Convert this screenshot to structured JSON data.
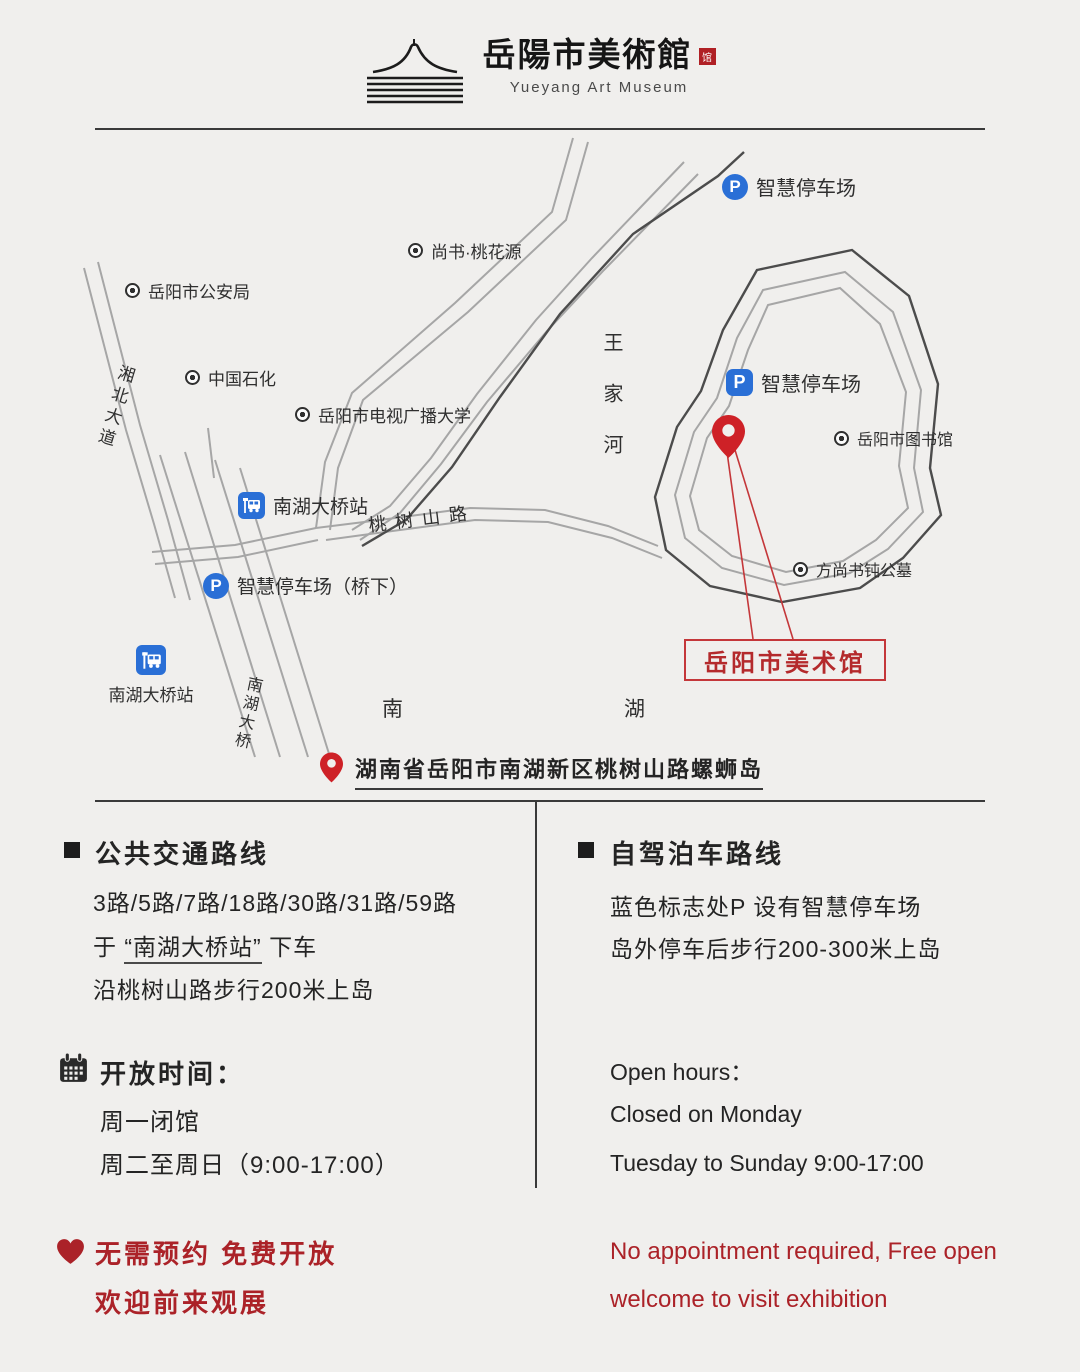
{
  "colors": {
    "red_text": "#ab2228",
    "red_line": "#c4373a",
    "blue": "#2a6fd6",
    "ink": "#2d2d2d",
    "bg": "#f0efed"
  },
  "logo": {
    "title_zh": "岳陽市美術館",
    "seal": "馆",
    "title_en": "Yueyang Art Museum"
  },
  "map": {
    "labels": {
      "p_letter": "P",
      "parking_top": "智慧停车场",
      "taohuayuan": "尚书·桃花源",
      "police": "岳阳市公安局",
      "sinopec": "中国石化",
      "university": "岳阳市电视广播大学",
      "parking_island": "智慧停车场",
      "library": "岳阳市图书馆",
      "bus_top": "南湖大桥站",
      "parking_bridge": "智慧停车场（桥下）",
      "tomb": "方尚书钝公墓",
      "bus_bottom": "南湖大桥站",
      "wangjiahe": "王家河",
      "xiangbei_avenue": "湘北大道",
      "taoshushan_road": "桃树山路",
      "nanhu_bridge": "南湖大桥",
      "lake_nan": "南",
      "lake_hu": "湖",
      "museum_callout": "岳阳市美术馆"
    }
  },
  "address": {
    "text": "湖南省岳阳市南湖新区桃树山路螺蛳岛"
  },
  "transit": {
    "title": "公共交通路线",
    "routes": "3路/5路/7路/18路/30路/31路/59路",
    "line2_prefix": "于",
    "line2_station": "“南湖大桥站”",
    "line2_suffix": "下车",
    "line3": "沿桃树山路步行200米上岛"
  },
  "driving": {
    "title": "自驾泊车路线",
    "line1": "蓝色标志处P 设有智慧停车场",
    "line2": "岛外停车后步行200-300米上岛"
  },
  "hours_zh": {
    "title": "开放时间：",
    "line1": "周一闭馆",
    "line2": "周二至周日（9:00-17:00）"
  },
  "hours_en": {
    "title": "Open hours：",
    "line1": "Closed on Monday",
    "line2": "Tuesday to Sunday 9:00-17:00"
  },
  "notice_zh": {
    "line1": "无需预约  免费开放",
    "line2": "欢迎前来观展"
  },
  "notice_en": {
    "line1": "No appointment required, Free open",
    "line2": "welcome to visit exhibition"
  }
}
